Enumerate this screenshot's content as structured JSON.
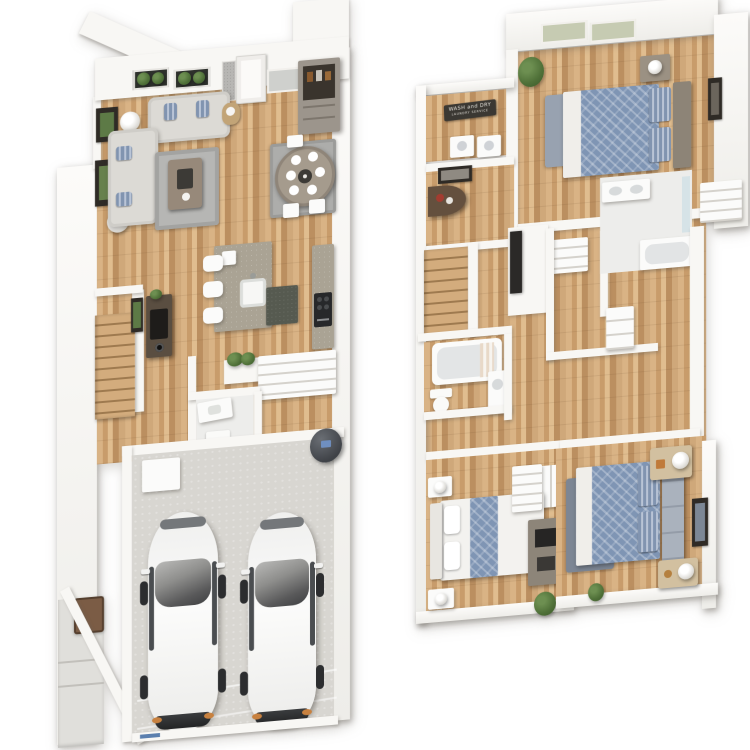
{
  "scene": {
    "type": "3d-floorplan-render",
    "background": "#ffffff",
    "floors_shown": 2
  },
  "colors": {
    "wall": "#f8f7f4",
    "wall_shadow": "#d9d7d2",
    "wood_floor": "#c79e6f",
    "garage_floor": "#d8d6d1",
    "rug_gray": "#aeaeac",
    "rug_slate": "#7d8694",
    "sofa_gray": "#dcdad5",
    "pillow_blue": "#8194b0",
    "bed_quilt_blue": "#7f95b4",
    "granite": "#aaa394",
    "granite_dark": "#565a50",
    "furniture_dark_wood": "#5a4e41",
    "cabinet_taupe": "#9c958c",
    "nightstand_cream": "#d2c0a0",
    "plant_green": "#4f7038",
    "car_white": "#f4f4f3",
    "car_glass": "#3f4042",
    "headlight_orange": "#c8813f",
    "water_heater": "#45484d",
    "garage_threshold_blue": "#5b7fae",
    "sign_bg": "#3b3833",
    "sign_text": "#e6e3dc"
  },
  "floor1": {
    "name": "first-floor",
    "rooms": [
      {
        "name": "living-room",
        "furniture": [
          "sofa",
          "loveseat",
          "coffee-table",
          "area-rug",
          "floor-lamp",
          "floor-lamp",
          "wall-art",
          "wall-art",
          "plant-window",
          "plant-window",
          "basket"
        ]
      },
      {
        "name": "entry",
        "furniture": [
          "front-door",
          "sidelight",
          "window",
          "bar-cabinet"
        ]
      },
      {
        "name": "dining-area",
        "furniture": [
          "round-table",
          "plates-x6",
          "chairs",
          "area-rug"
        ]
      },
      {
        "name": "kitchen",
        "furniture": [
          "island-with-sink",
          "bar-stools-x3",
          "dark-mat",
          "counter",
          "range"
        ]
      },
      {
        "name": "hall",
        "furniture": [
          "console-table",
          "framed-art",
          "planter-half-wall"
        ]
      },
      {
        "name": "staircase",
        "furniture": [
          "wood-steps"
        ]
      },
      {
        "name": "pantry",
        "furniture": [
          "shelves"
        ]
      },
      {
        "name": "powder-room",
        "furniture": [
          "vanity",
          "toilet"
        ]
      },
      {
        "name": "garage",
        "furniture": [
          "car",
          "car",
          "water-heater",
          "storage-cabinet",
          "garage-door",
          "threshold"
        ]
      },
      {
        "name": "entry-porch",
        "furniture": [
          "steps",
          "welcome-mat"
        ]
      }
    ]
  },
  "floor2": {
    "name": "second-floor",
    "laundry_sign": {
      "line1": "WASH and DRY",
      "line2": "LAUNDRY SERVICE"
    },
    "rooms": [
      {
        "name": "master-bedroom",
        "furniture": [
          "bed-queen-blue",
          "nightstand",
          "nightstand",
          "lamps",
          "area-rug",
          "wall-art",
          "plant",
          "window",
          "window"
        ]
      },
      {
        "name": "laundry-room",
        "furniture": [
          "wall-sign",
          "washer",
          "dryer"
        ]
      },
      {
        "name": "hall-nook",
        "furniture": [
          "half-round-console",
          "framed-art"
        ]
      },
      {
        "name": "staircase",
        "furniture": [
          "wood-steps"
        ]
      },
      {
        "name": "hall",
        "furniture": [
          "tv-cabinet",
          "linen-closet",
          "white-dresser"
        ]
      },
      {
        "name": "bathroom",
        "furniture": [
          "tub",
          "toilet",
          "vanity"
        ]
      },
      {
        "name": "master-bath",
        "furniture": [
          "double-vanity",
          "shower-tub",
          "walk-in-closet"
        ]
      },
      {
        "name": "bedroom-2",
        "furniture": [
          "bed-white-blue",
          "nightstand",
          "nightstand",
          "dresser-with-tv",
          "wardrobe",
          "plant"
        ]
      },
      {
        "name": "bedroom-3",
        "furniture": [
          "bed-blue-pattern",
          "nightstand",
          "nightstand",
          "lamps",
          "area-rug",
          "wall-art",
          "plant"
        ]
      }
    ]
  }
}
